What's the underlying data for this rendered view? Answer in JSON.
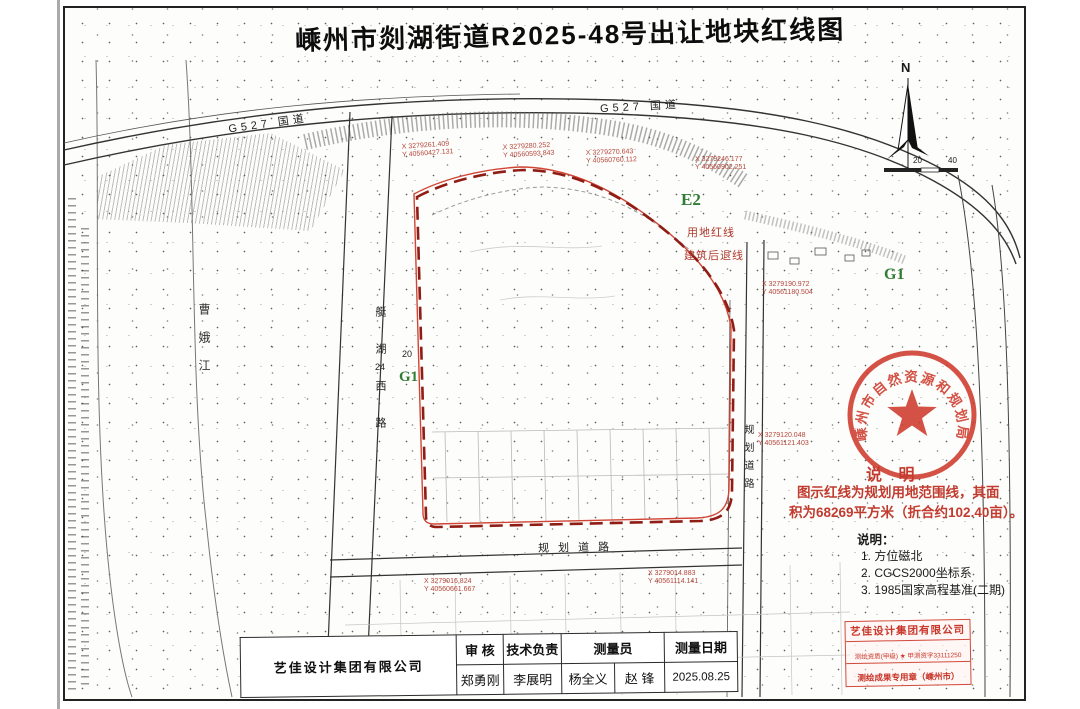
{
  "title": "嵊州市剡湖街道R2025-48号出让地块红线图",
  "map": {
    "highway_label_left": "G527 国道",
    "highway_label_right": "G527 国道",
    "river_name": "曹娥江",
    "road_west_name": "艇湖西路",
    "road_east_name": "规划道路",
    "road_south_name": "规划道路",
    "zone_e2": "E2",
    "zone_g1_east": "G1",
    "zone_g1_west": "G1",
    "red_line_label": "用地红线",
    "setback_label": "建筑后退线",
    "road_width_20": "20",
    "road_width_24": "24",
    "north_label": "N",
    "scale_20": "20",
    "scale_40": "40",
    "coords": [
      {
        "x": "X 3279261.409",
        "y": "Y 40560427.131"
      },
      {
        "x": "X 3279280.252",
        "y": "Y 40560593.843"
      },
      {
        "x": "X 3279270.643",
        "y": "Y 40560760.112"
      },
      {
        "x": "X 3279246.177",
        "y": "Y 40560902.251"
      },
      {
        "x": "X 3279120.048",
        "y": "Y 40561121.403"
      },
      {
        "x": "X 3279014.883",
        "y": "Y 40561114.141"
      },
      {
        "x": "X 3279016.824",
        "y": "Y 40560661.667"
      },
      {
        "x": "X 3279190.972",
        "y": "Y 40561180.504"
      }
    ]
  },
  "seal": {
    "arc_text": "嵊州市自然资源和规划局"
  },
  "notes": {
    "heading": "说 明",
    "line1": "图示红线为规划用地范围线，其面",
    "line2": "积为68269平方米（折合约102.40亩）。",
    "sub_heading": "说明：",
    "item1": "1. 方位磁北",
    "item2": "2. CGCS2000坐标系",
    "item3": "3. 1985国家高程基准(二期)"
  },
  "table": {
    "company": "艺佳设计集团有限公司",
    "col_review": "审 核",
    "col_tech": "技术负责",
    "col_surveyor": "测量员",
    "col_date": "测量日期",
    "reviewer": "郑勇刚",
    "tech_lead": "李展明",
    "surveyor1": "杨全义",
    "surveyor2": "赵 锋",
    "date": "2025.08.25"
  },
  "stamp": {
    "line1": "艺佳设计集团有限公司",
    "line2": "测绘资质(甲级) ★ 甲测资字33111250",
    "line3": "测绘成果专用章（嵊州市）"
  },
  "colors": {
    "red_line": "#c0392b",
    "seal_red": "#cf3a2c",
    "zone_green": "#2f7d35"
  }
}
